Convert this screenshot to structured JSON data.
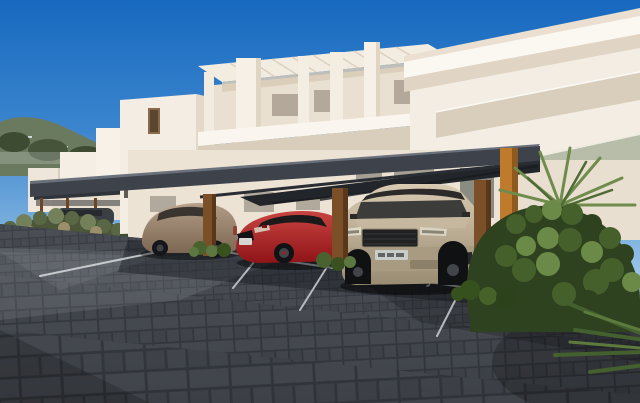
{
  "scene": {
    "type": "exterior-architectural-render",
    "description": "Modern white apartment complex with a flat charcoal carport sheltering three cars, dark basketweave paver driveway with painted bay numbers, landscaped shrubs and palms under a clear blue sky, hillside town in the distance",
    "parking": {
      "left_space_number": "29",
      "right_space_number": "30"
    },
    "vehicles": [
      {
        "name": "bronze hatchback",
        "bay": "left"
      },
      {
        "name": "red coupe",
        "bay": "middle"
      },
      {
        "name": "champagne SUV",
        "bay": "right"
      },
      {
        "name": "dark car",
        "bay": "distant carport"
      }
    ],
    "colors": {
      "sky_top": "#1769bf",
      "sky_horizon": "#b9d6f0",
      "building_wall": "#f4ede3",
      "building_recess": "#d9cdbc",
      "glass_balustrade": "#b7bda9",
      "carport_roof": "#3e434b",
      "carport_soffit": "#22252a",
      "wood_post": "#7b4f28",
      "accent_post": "#c07a2b",
      "pavement_joint": "#2e3138",
      "pavement_brick": "#474b52",
      "parking_marking": "#dfe3e6",
      "bush_dark": "#2e421f",
      "bush_light": "#6c8a47",
      "hill_green": "#6a7a5e",
      "car_bronze": "#7c6753",
      "car_red": "#8f1418",
      "car_suv_champagne": "#9a8c72",
      "car_distant": "#3b3e42"
    }
  }
}
